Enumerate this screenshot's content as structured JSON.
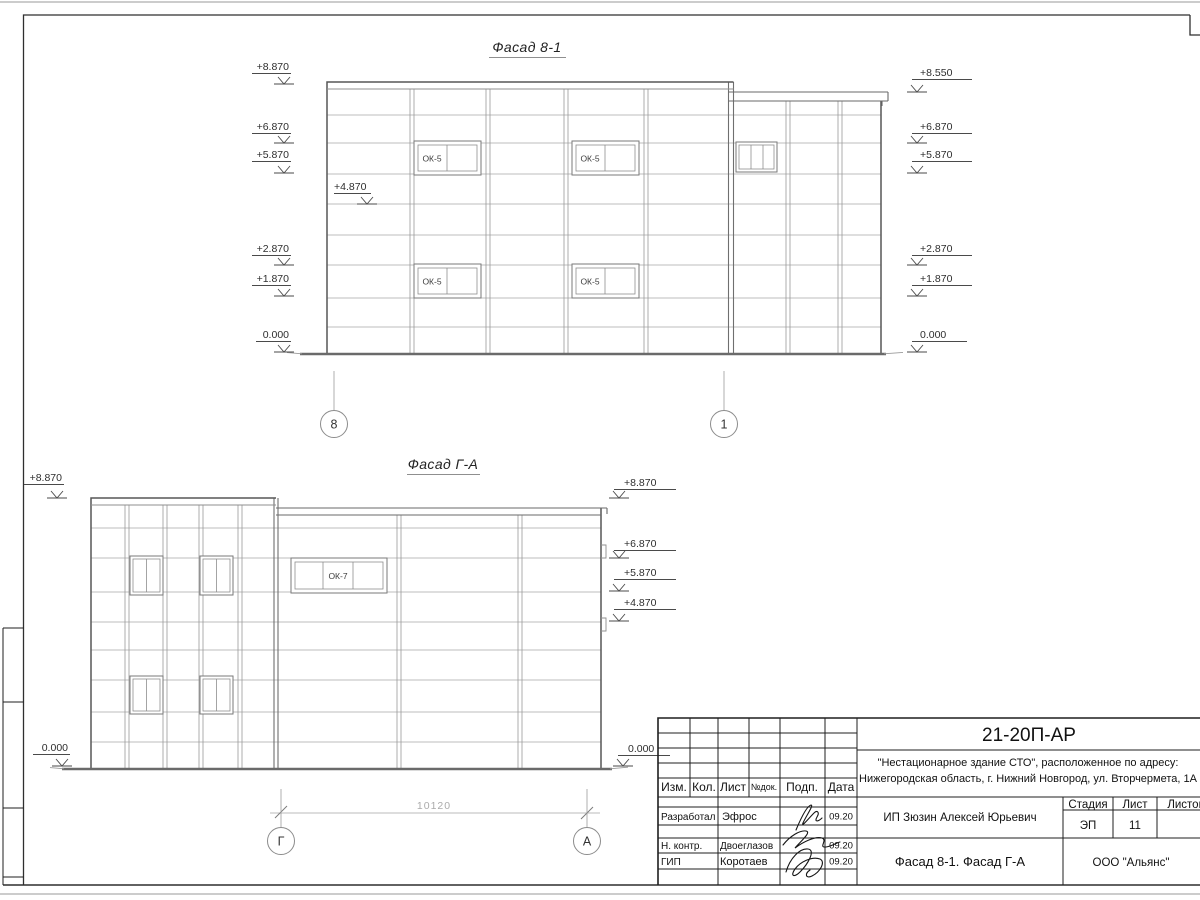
{
  "drawing": {
    "facade1": {
      "title": "Фасад 8-1",
      "window_label": "ОК-5",
      "marks_left": [
        "+8.870",
        "+6.870",
        "+5.870",
        "+2.870",
        "+1.870",
        "0.000"
      ],
      "mark_inner": "+4.870",
      "marks_right": [
        "+8.550",
        "+6.870",
        "+5.870",
        "+2.870",
        "+1.870",
        "0.000"
      ],
      "axes": [
        "8",
        "1"
      ]
    },
    "facade2": {
      "title": "Фасад Г-А",
      "window_label": "ОК-7",
      "marks_left": [
        "+8.870",
        "0.000"
      ],
      "marks_right": [
        "+8.870",
        "+6.870",
        "+5.870",
        "+4.870",
        "0.000"
      ],
      "axes": [
        "Г",
        "А"
      ],
      "dimension": "10120"
    }
  },
  "title_block": {
    "doc_number": "21-20П-АР",
    "project_address_line1": "\"Нестационарное здание СТО\", расположенное по адресу:",
    "project_address_line2": "Нижегородская область, г. Нижний Новгород, ул. Вторчермета, 1А",
    "columns": [
      "Изм.",
      "Кол.",
      "Лист",
      "№док.",
      "Подп.",
      "Дата"
    ],
    "signature_rows": [
      {
        "role": "Разработал",
        "name": "Эфрос",
        "date": "09.20"
      },
      {
        "role": "Н. контр.",
        "name": "Двоеглазов",
        "date": "09.20"
      },
      {
        "role": "ГИП",
        "name": "Коротаев",
        "date": "09.20"
      }
    ],
    "client": "ИП Зюзин Алексей Юрьевич",
    "stage_label": "Стадия",
    "stage_value": "ЭП",
    "sheet_label": "Лист",
    "sheet_value": "11",
    "sheets_label": "Листов",
    "drawing_title": "Фасад 8-1. Фасад Г-А",
    "company": "ООО \"Альянс\""
  }
}
